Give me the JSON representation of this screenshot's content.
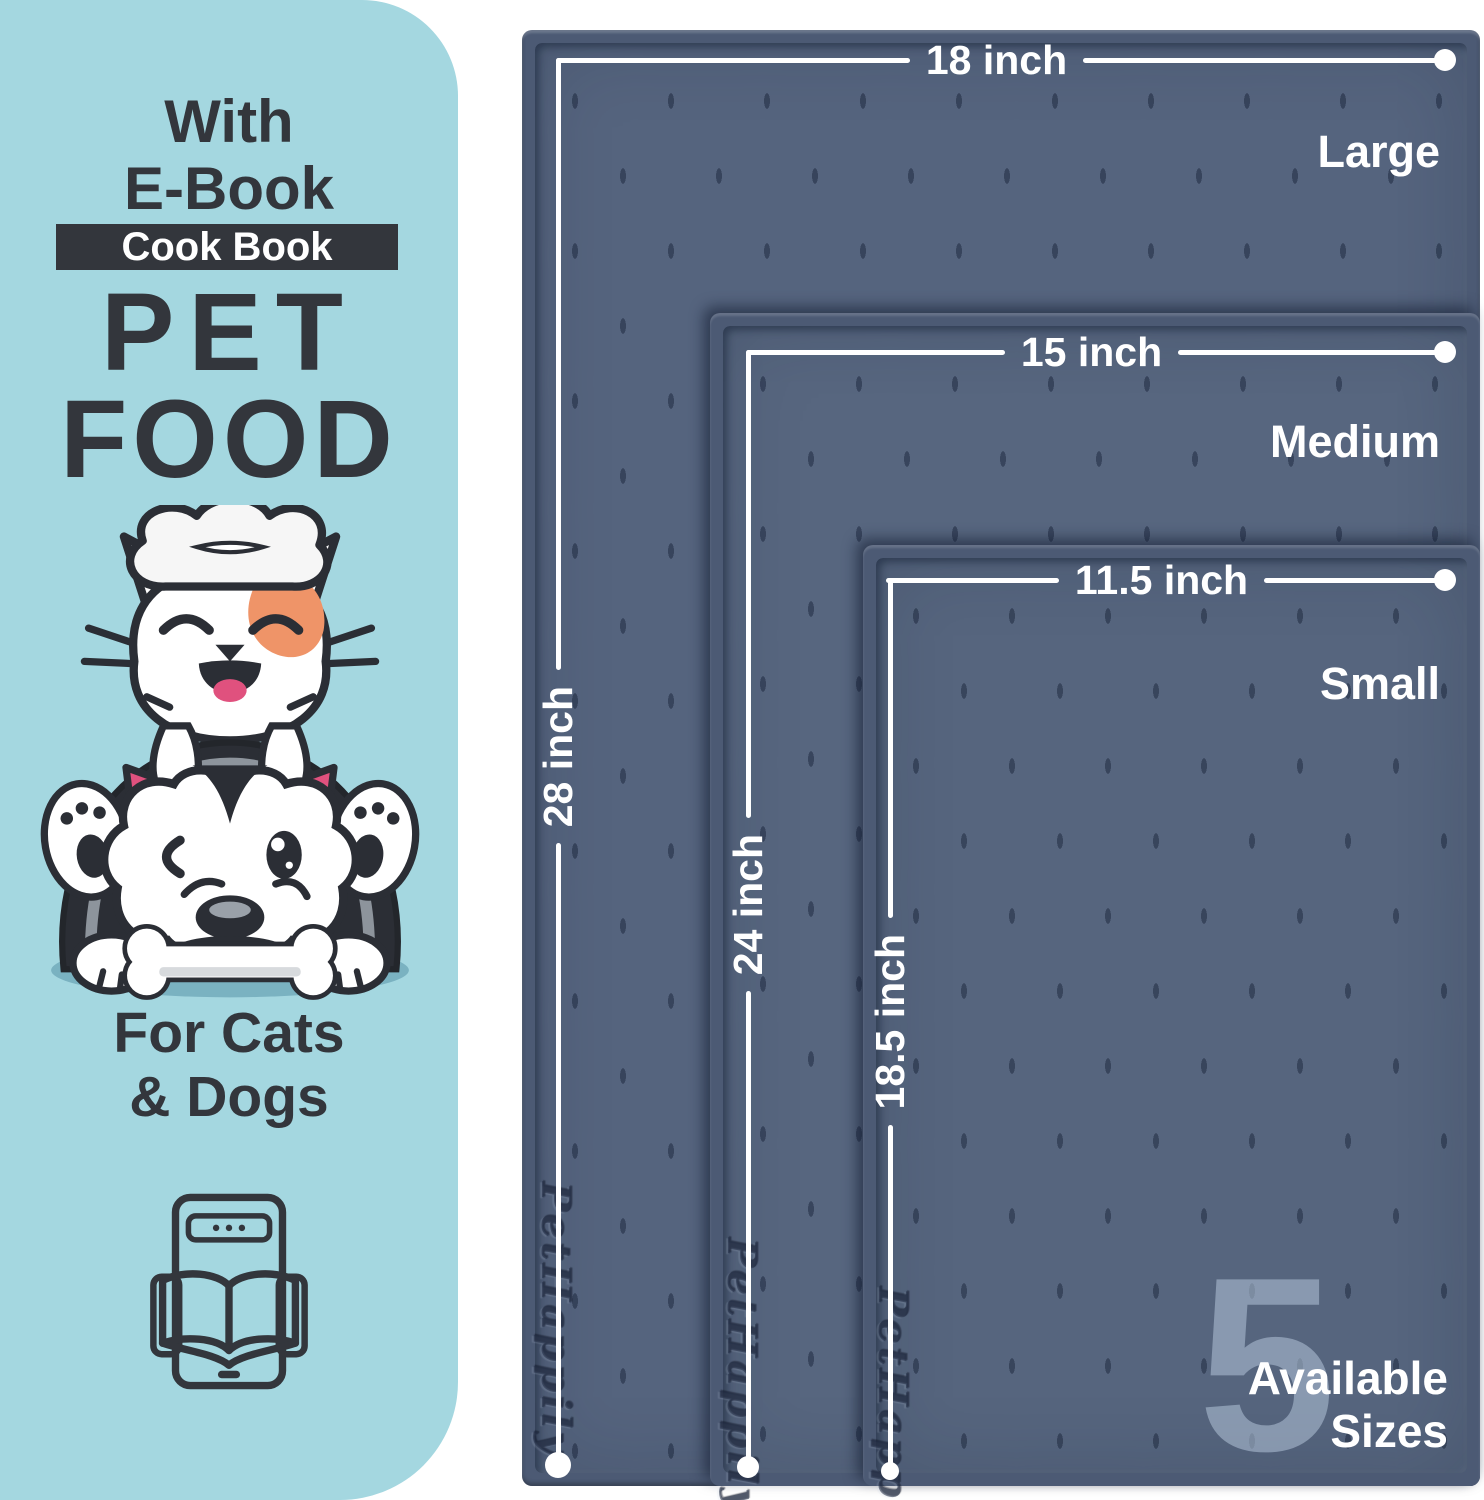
{
  "panel": {
    "ebook_line1": "With",
    "ebook_line2": "E-Book",
    "badge_label": "Cook Book",
    "title_line1": "PET",
    "title_line2": "FOOD",
    "audience_line1": "For Cats",
    "audience_line2": "& Dogs"
  },
  "mats": [
    {
      "size_name": "Large",
      "width_label": "18 inch",
      "length_label": "28 inch",
      "embossed_brand": "PetHappily"
    },
    {
      "size_name": "Medium",
      "width_label": "15 inch",
      "length_label": "24 inch",
      "embossed_brand": "PetHappily"
    },
    {
      "size_name": "Small",
      "width_label": "11.5 inch",
      "length_label": "18.5 inch",
      "embossed_brand": "PetHappily"
    }
  ],
  "sizes_callout": {
    "count": "5",
    "line1": "Available",
    "line2": "Sizes"
  },
  "colors": {
    "panel_bg": "#a4d7e0",
    "ink": "#33363c",
    "mat_rim": "#4c5a74",
    "mat_surface": "#55647e",
    "dimension_white": "#ffffff",
    "watermark": "#aebfd4",
    "cat_patch_orange": "#ef9468",
    "pink_accent": "#e0517e",
    "shadow_teal": "#7ab2c1"
  }
}
